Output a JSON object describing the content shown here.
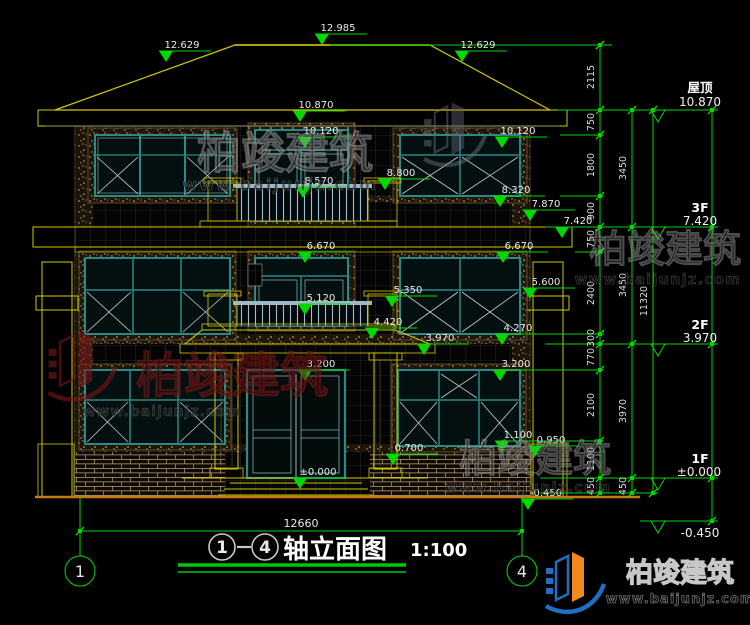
{
  "marks": {
    "m12985": "12.985",
    "m12629": "12.629",
    "m10870": "10.870",
    "m10120": "10.120",
    "m8800": "8.800",
    "m8570": "8.570",
    "m8320": "8.320",
    "m7870": "7.870",
    "m7420": "7.420",
    "m6670": "6.670",
    "m5600": "5.600",
    "m5350": "5.350",
    "m5120": "5.120",
    "m4420": "4.420",
    "m4270": "4.270",
    "m3970": "3.970",
    "m3200": "3.200",
    "m1100": "1.100",
    "m0950": "0.950",
    "m0700": "0.700",
    "m0000": "±0.000",
    "mn0450": "-0.450"
  },
  "dims": {
    "a": [
      "2115",
      "750",
      "1800",
      "900",
      "750",
      "2400",
      "300",
      "770",
      "2100",
      "1100",
      "450"
    ],
    "b": [
      "3450",
      "3450",
      "3970",
      "450"
    ],
    "total": "11320",
    "width": "12660"
  },
  "levels": {
    "roof_label": "屋顶",
    "roof_value": "10.870",
    "f3_label": "3F",
    "f3_value": "7.420",
    "f2_label": "2F",
    "f2_value": "3.970",
    "f1_label": "1F",
    "f1_value": "±0.000",
    "base_value": "-0.450"
  },
  "footer": {
    "axis_left": "1",
    "axis_right": "4",
    "title": "轴立面图",
    "scale": "1:100"
  },
  "brand": {
    "name": "柏竣建筑",
    "url": "www.baijunjz.com"
  },
  "colors": {
    "dim_green": "#00d800",
    "outline_yellow": "#d4c800",
    "window_teal": "#2d8888",
    "ground_orange": "#c87818",
    "logo_blue": "#1f6fc4",
    "logo_orange": "#f08a1e",
    "watermark_red": "#7a1818"
  }
}
